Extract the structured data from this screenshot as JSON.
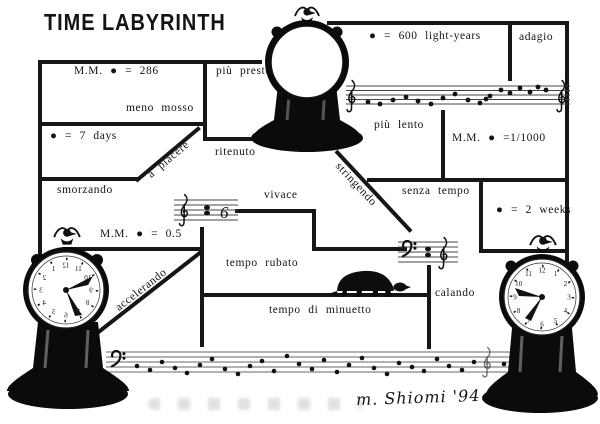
{
  "title": "TIME LABYRINTH",
  "signature": "m. Shiomi '94",
  "labels": {
    "mm_286": "M.M. ● = 286",
    "piu_presto": "più presto",
    "meno_mosso": "meno mosso",
    "seven_days": "● = 7 days",
    "a_piacere": "a piacere",
    "smorzando": "smorzando",
    "ritenuto": "ritenuto",
    "vivace": "vivace",
    "mm_05": "M.M. ● = 0.5",
    "accelerando": "accelerando",
    "tempo_rubato": "tempo rubato",
    "tempo_di_minuetto": "tempo di minuetto",
    "calando": "calando",
    "stringendo": "stringendo",
    "senza_tempo": "senza tempo",
    "two_weeks": "● = 2 weeks",
    "mm_1_1000": "M.M. ● =1/1000",
    "light_years": "● = 600 light-years",
    "adagio": "adagio",
    "piu_lento": "più lento"
  },
  "music": {
    "figure_six": "6"
  },
  "clocks": {
    "numerals": [
      "1",
      "2",
      "3",
      "4",
      "5",
      "6",
      "7",
      "8",
      "9",
      "10",
      "11",
      "12"
    ]
  }
}
